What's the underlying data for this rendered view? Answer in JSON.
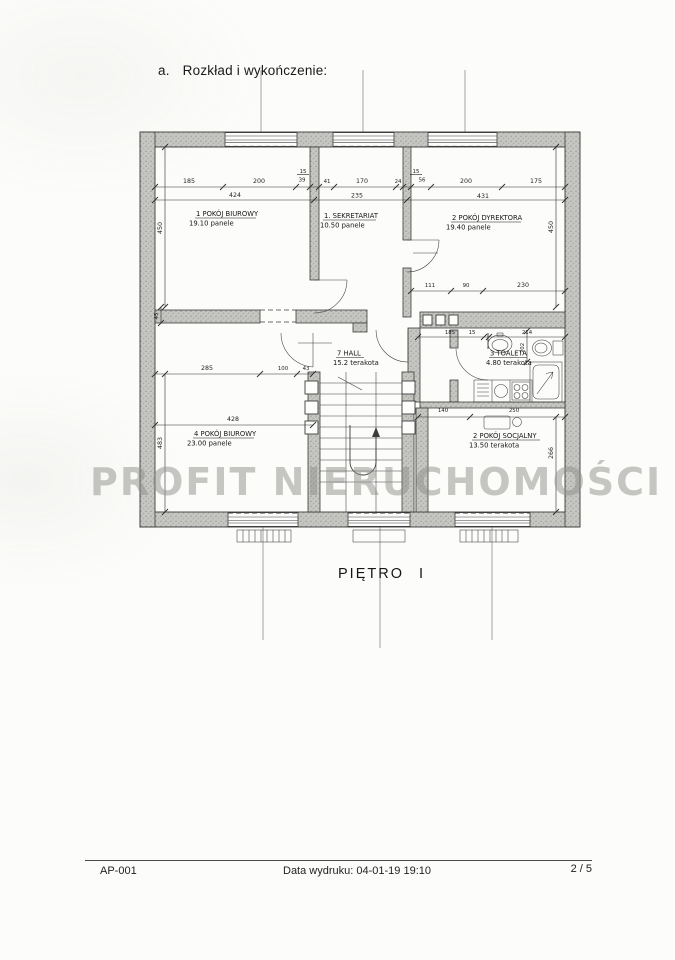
{
  "document": {
    "section_heading": {
      "index": "a.",
      "text": "Rozkład i wykończenie:"
    },
    "plan_caption": "PIĘTRO I",
    "watermark": "PROFIT NIERUCHOMOŚCI",
    "footer": {
      "doc_code": "AP-001",
      "print_info": "Data wydruku: 04-01-19 19:10",
      "page_indicator": "2 / 5"
    }
  },
  "plan": {
    "rooms": [
      {
        "title": "1 POKÓJ BIUROWY",
        "detail": "19.10 panele"
      },
      {
        "title": "1. SEKRETARIAT",
        "detail": "10.50 panele"
      },
      {
        "title": "2 POKÓJ DYREKTORA",
        "detail": "19.40 panele"
      },
      {
        "title": "7 HALL",
        "detail": "15.2 terakota"
      },
      {
        "title": "3 TOALETA",
        "detail": "4.80 terakota"
      },
      {
        "title": "4 POKÓJ BIUROWY",
        "detail": "23.00 panele"
      },
      {
        "title": "2 POKÓJ SOCJALNY",
        "detail": "13.50 terakota"
      }
    ],
    "dims": {
      "t185": "185",
      "t200a": "200",
      "t15a": "15",
      "t39": "39",
      "t41": "41",
      "t170": "170",
      "t24": "24",
      "t15b": "15",
      "t56": "56",
      "t200b": "200",
      "t175": "175",
      "t424": "424",
      "t235": "235",
      "t431": "431",
      "v450l": "450",
      "v450r": "450",
      "m111": "111",
      "m90": "90",
      "m230": "230",
      "b285": "285",
      "b100": "100",
      "b43": "43",
      "b428": "428",
      "v483": "483",
      "v45": "45",
      "w185": "185",
      "w15": "15",
      "w214": "214",
      "v202": "202",
      "s140": "140",
      "s250": "250",
      "v266": "266"
    }
  }
}
